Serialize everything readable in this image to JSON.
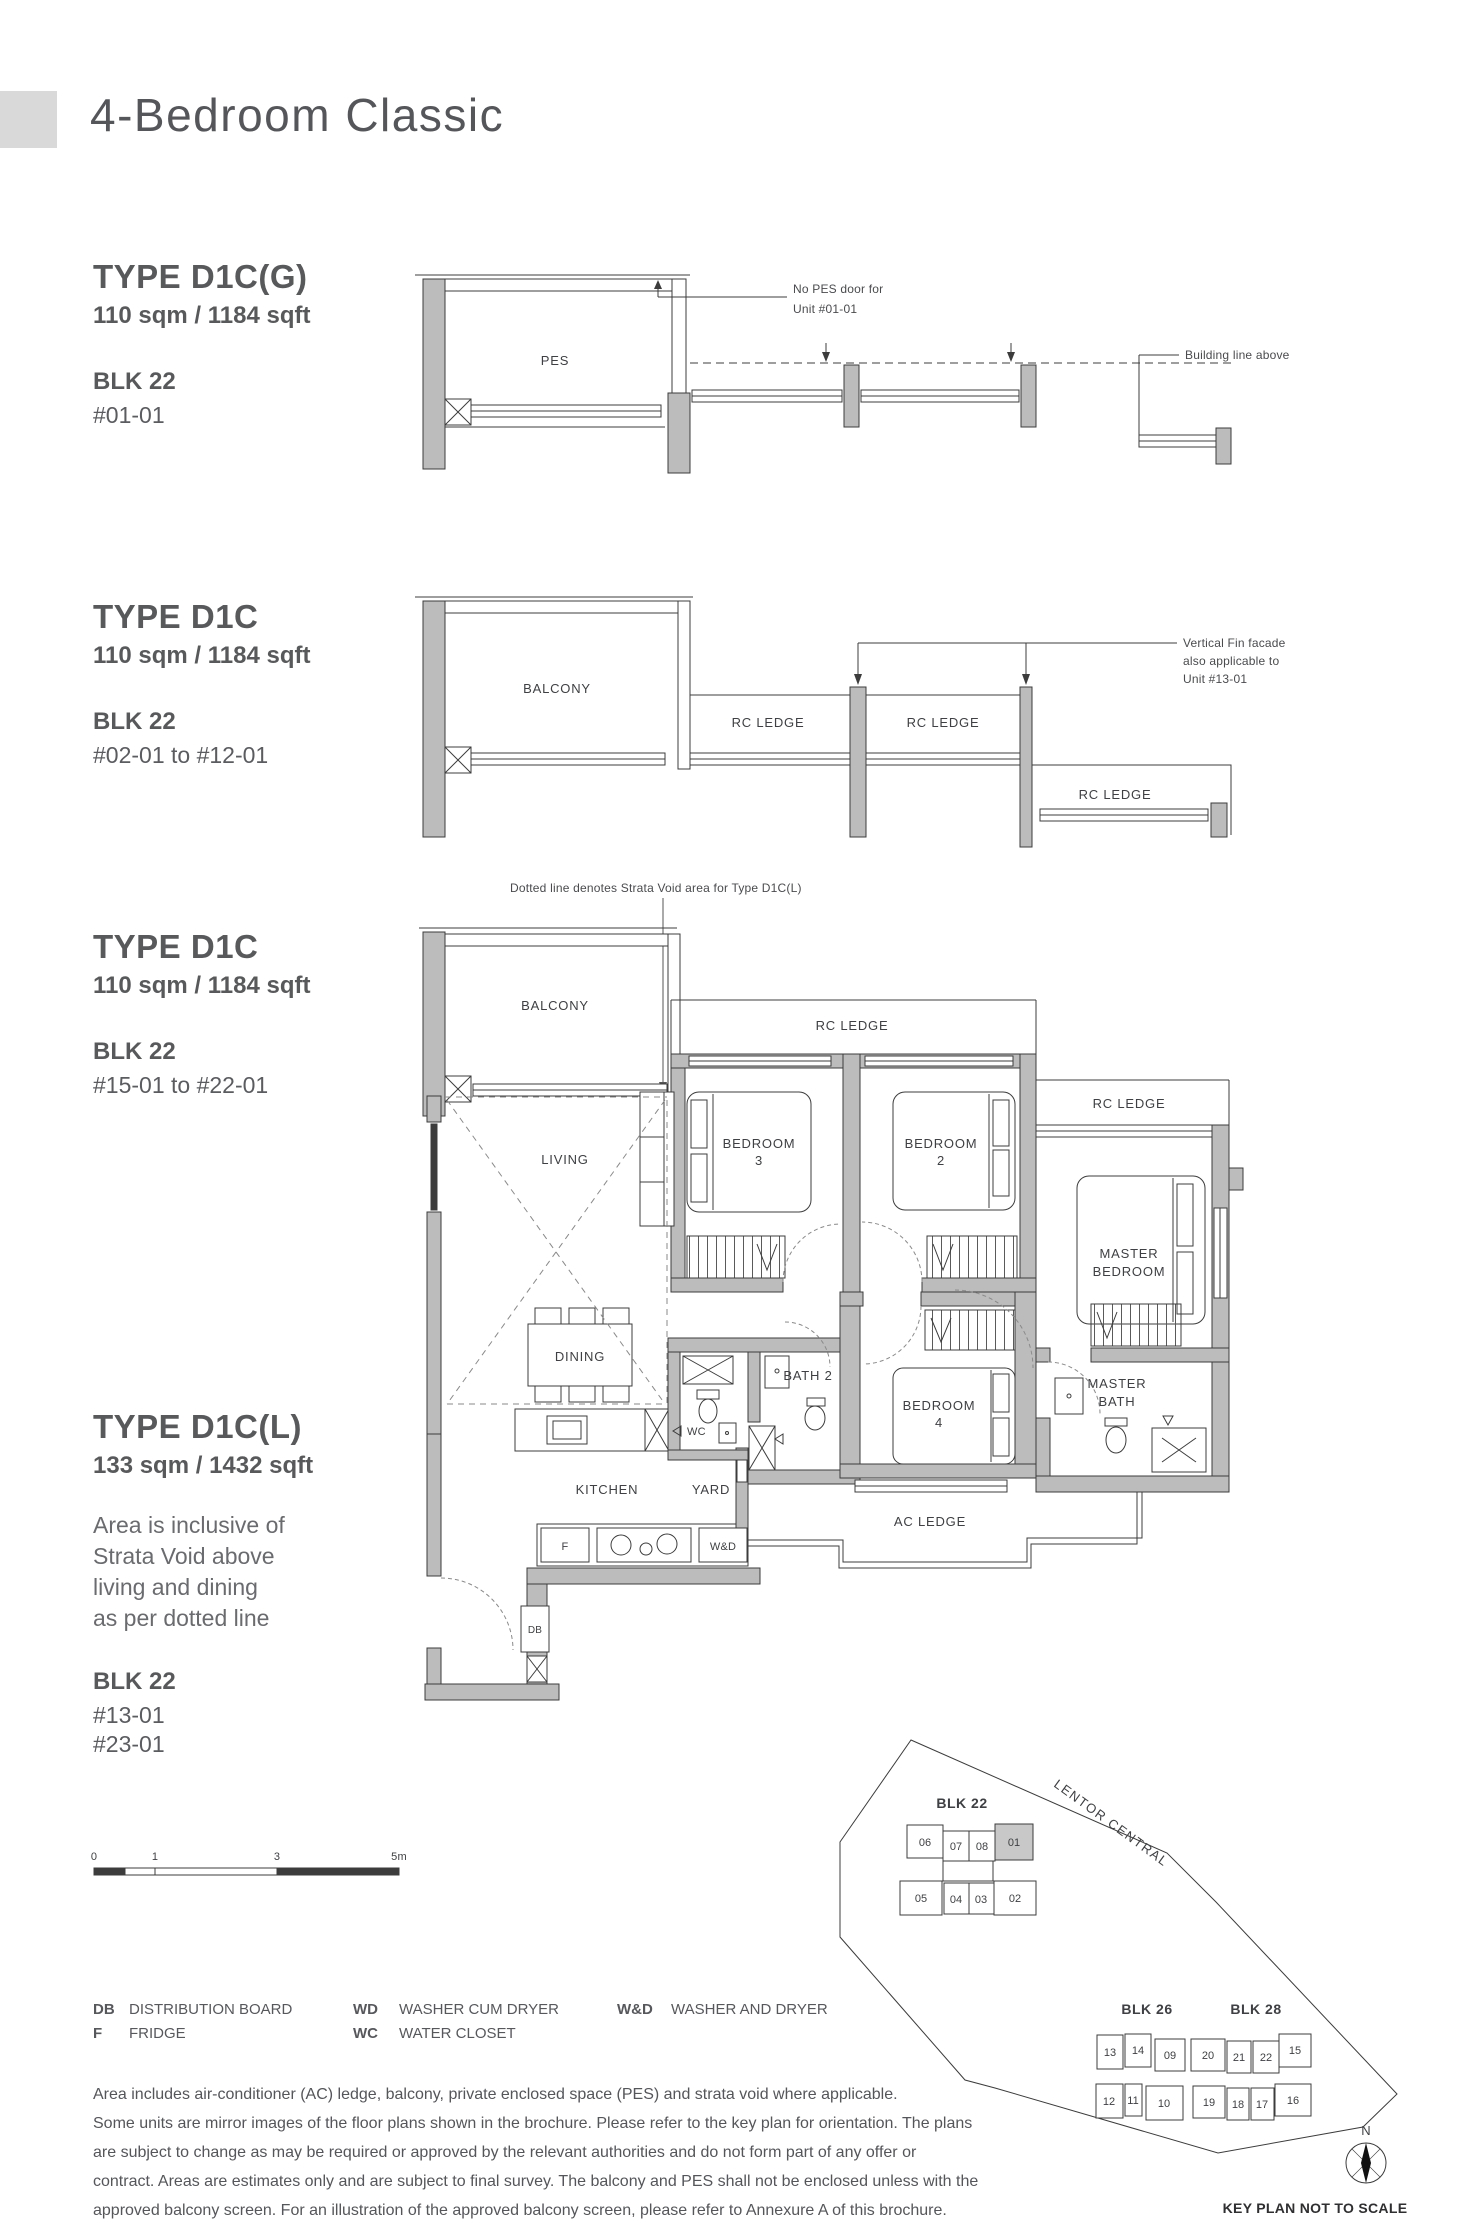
{
  "page": {
    "title": "4-Bedroom Classic"
  },
  "sections": [
    {
      "type_name": "TYPE D1C(G)",
      "area": "110 sqm / 1184 sqft",
      "blk": "BLK 22",
      "units": [
        "#01-01"
      ]
    },
    {
      "type_name": "TYPE D1C",
      "area": "110 sqm / 1184 sqft",
      "blk": "BLK 22",
      "units": [
        "#02-01 to #12-01"
      ]
    },
    {
      "type_name": "TYPE D1C",
      "area": "110 sqm / 1184 sqft",
      "blk": "BLK 22",
      "units": [
        "#15-01 to #22-01"
      ]
    },
    {
      "type_name": "TYPE D1C(L)",
      "area": "133 sqm / 1432 sqft",
      "note_lines": [
        "Area is inclusive of",
        "Strata Void above",
        "living and dining",
        "as per dotted line"
      ],
      "blk": "BLK 22",
      "units": [
        "#13-01",
        "#23-01"
      ]
    }
  ],
  "plan1": {
    "rooms": {
      "pes": "PES"
    },
    "annotations": {
      "no_pes_1": "No PES door for",
      "no_pes_2": "Unit #01-01",
      "building_line": "Building line above"
    }
  },
  "plan2": {
    "rooms": {
      "balcony": "BALCONY",
      "rc_a": "RC LEDGE",
      "rc_b": "RC LEDGE",
      "rc_c": "RC LEDGE"
    },
    "annotations": {
      "fin_1": "Vertical Fin facade",
      "fin_2": "also applicable to",
      "fin_3": "Unit #13-01"
    }
  },
  "plan3": {
    "note": "Dotted line denotes Strata Void area for Type D1C(L)",
    "rooms": {
      "balcony": "BALCONY",
      "living": "LIVING",
      "dining": "DINING",
      "kitchen": "KITCHEN",
      "yard": "YARD",
      "wc": "WC",
      "bath2": "BATH 2",
      "rc_top": "RC LEDGE",
      "rc_right": "RC LEDGE",
      "ac": "AC LEDGE",
      "br3_1": "BEDROOM",
      "br3_2": "3",
      "br2_1": "BEDROOM",
      "br2_2": "2",
      "br4_1": "BEDROOM",
      "br4_2": "4",
      "master_1": "MASTER",
      "master_2": "BEDROOM",
      "mbath_1": "MASTER",
      "mbath_2": "BATH"
    },
    "fixtures": {
      "f": "F",
      "wd": "W&D",
      "db": "DB"
    }
  },
  "legend": {
    "items": [
      {
        "key": "DB",
        "label": "DISTRIBUTION BOARD"
      },
      {
        "key": "F",
        "label": "FRIDGE"
      },
      {
        "key": "WD",
        "label": "WASHER CUM DRYER"
      },
      {
        "key": "WC",
        "label": "WATER CLOSET"
      },
      {
        "key": "W&D",
        "label": "WASHER AND DRYER"
      }
    ]
  },
  "scalebar": {
    "t0": "0",
    "t1": "1",
    "t3": "3",
    "t5": "5m"
  },
  "disclaimer": {
    "lines": [
      "Area includes air-conditioner (AC) ledge, balcony, private enclosed space (PES) and strata void where applicable.",
      "Some units are mirror images of the floor plans shown in the brochure. Please refer to the key plan for orientation. The plans",
      "are subject to change as may be required or approved by the relevant authorities and do not form part of any offer or",
      "contract. Areas are estimates only and are subject to final survey. The balcony and PES shall not be enclosed unless with the",
      "approved balcony screen. For an illustration of the approved balcony screen, please refer to Annexure A of this brochure."
    ]
  },
  "keyplan": {
    "road": "LENTOR CENTRAL",
    "caption": "KEY PLAN NOT TO SCALE",
    "north": "N",
    "blk22": {
      "name": "BLK 22",
      "top": [
        "06",
        "07",
        "08",
        "01"
      ],
      "bottom": [
        "05",
        "04",
        "03",
        "02"
      ]
    },
    "blk26": {
      "name": "BLK 26",
      "top": [
        "13",
        "14",
        "09"
      ],
      "bottom": [
        "12",
        "11",
        "10"
      ]
    },
    "blk28": {
      "name": "BLK 28",
      "top": [
        "20",
        "21",
        "22",
        "15"
      ],
      "bottom": [
        "19",
        "18",
        "17",
        "16"
      ]
    }
  },
  "colors": {
    "wall": "#bcbcbc",
    "line": "#3c3c3c",
    "text": "#58595b",
    "highlight_unit": "#c8c8c8"
  }
}
